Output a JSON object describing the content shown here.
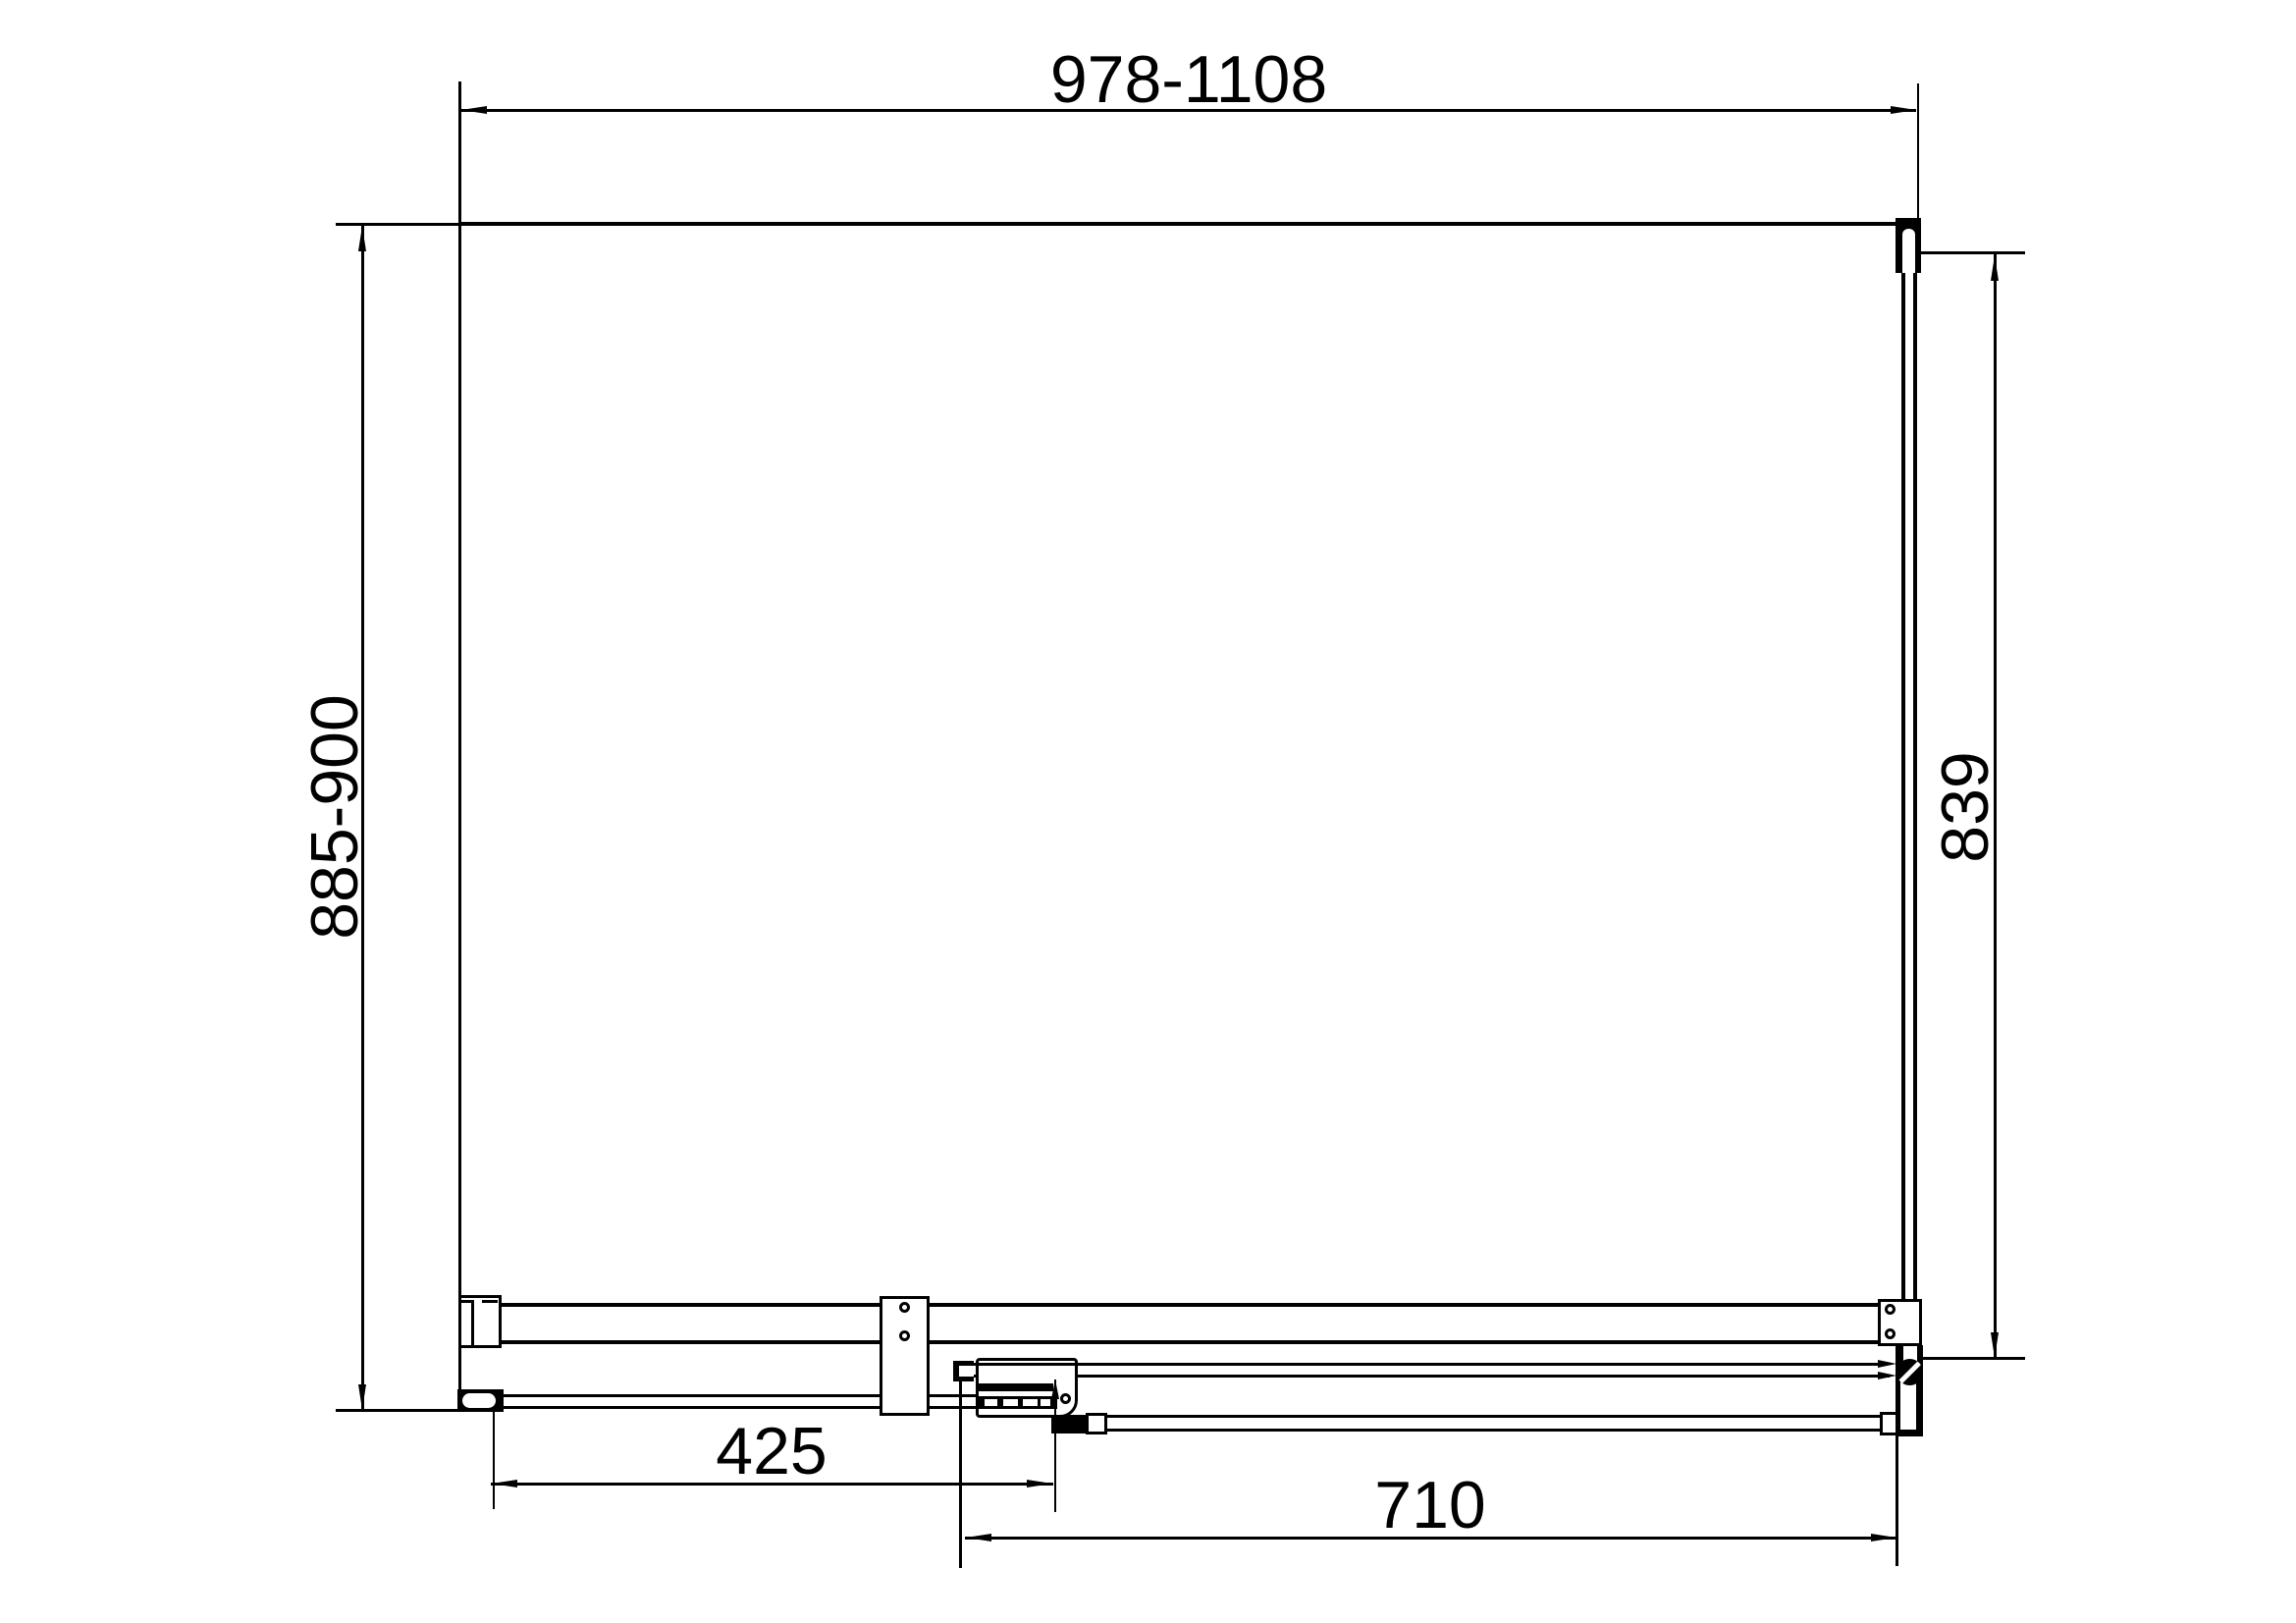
{
  "colors": {
    "background": "#ffffff",
    "line": "#000000"
  },
  "dimensions": {
    "top_width": {
      "label": "978-1108",
      "orientation": "horizontal"
    },
    "left_depth": {
      "label": "885-900",
      "orientation": "vertical"
    },
    "right_height": {
      "label": "839",
      "orientation": "vertical"
    },
    "bottom_left": {
      "label": "425",
      "orientation": "horizontal"
    },
    "bottom_right": {
      "label": "710",
      "orientation": "horizontal"
    }
  }
}
